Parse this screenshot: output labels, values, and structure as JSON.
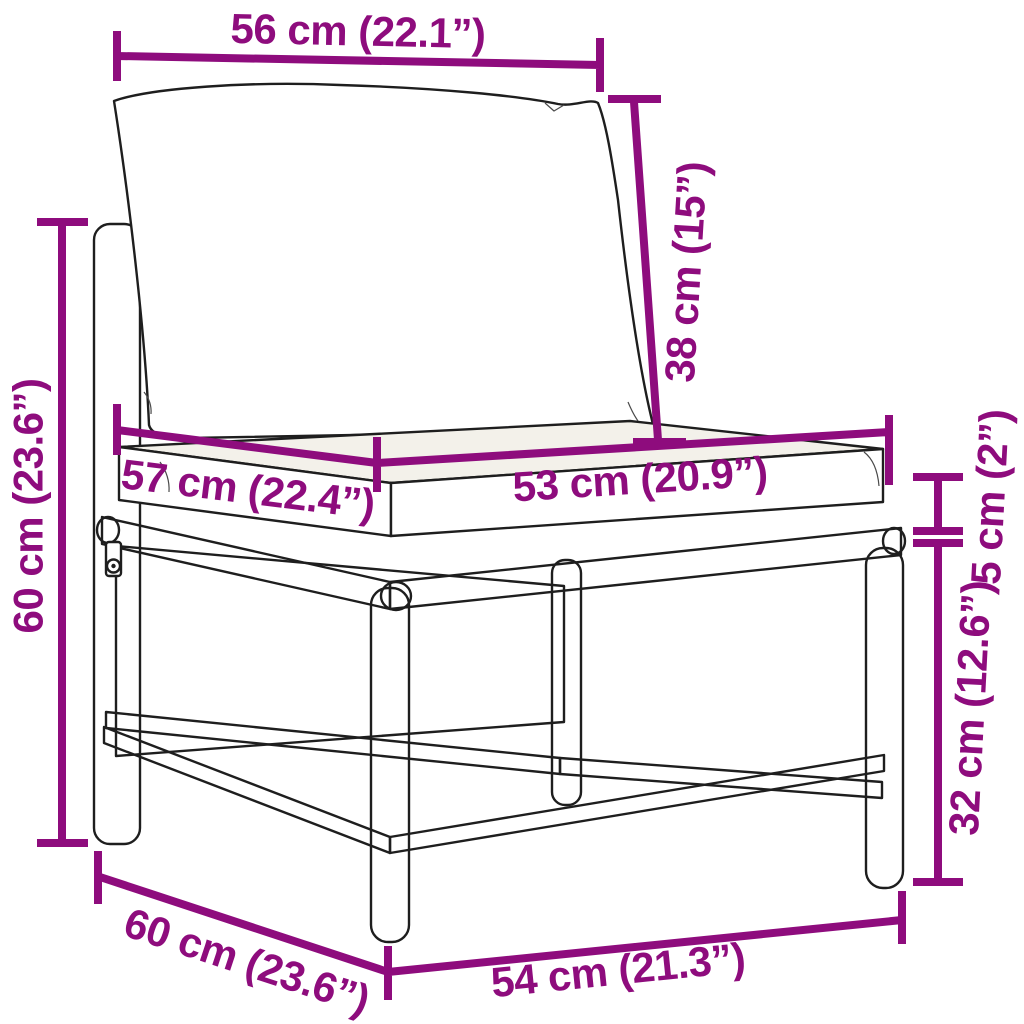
{
  "diagram": {
    "kind": "product dimension diagram",
    "subject": "poly rattan garden sofa middle section with back and seat cushions",
    "accent_color": "#8E0C7D",
    "line_color": "#1E1E1E",
    "background_color": "#FFFFFF"
  },
  "labels": {
    "back_cushion_width": "56 cm (22.1”)",
    "back_cushion_height": "38 cm (15”)",
    "overall_height": "60 cm (23.6”)",
    "seat_cushion_depth": "57 cm (22.4”)",
    "seat_cushion_width": "53 cm (20.9”)",
    "cushion_thickness": "5 cm (2”)",
    "seat_height": "32 cm (12.6”)",
    "base_depth": "60 cm (23.6”)",
    "base_width": "54 cm (21.3”)"
  }
}
